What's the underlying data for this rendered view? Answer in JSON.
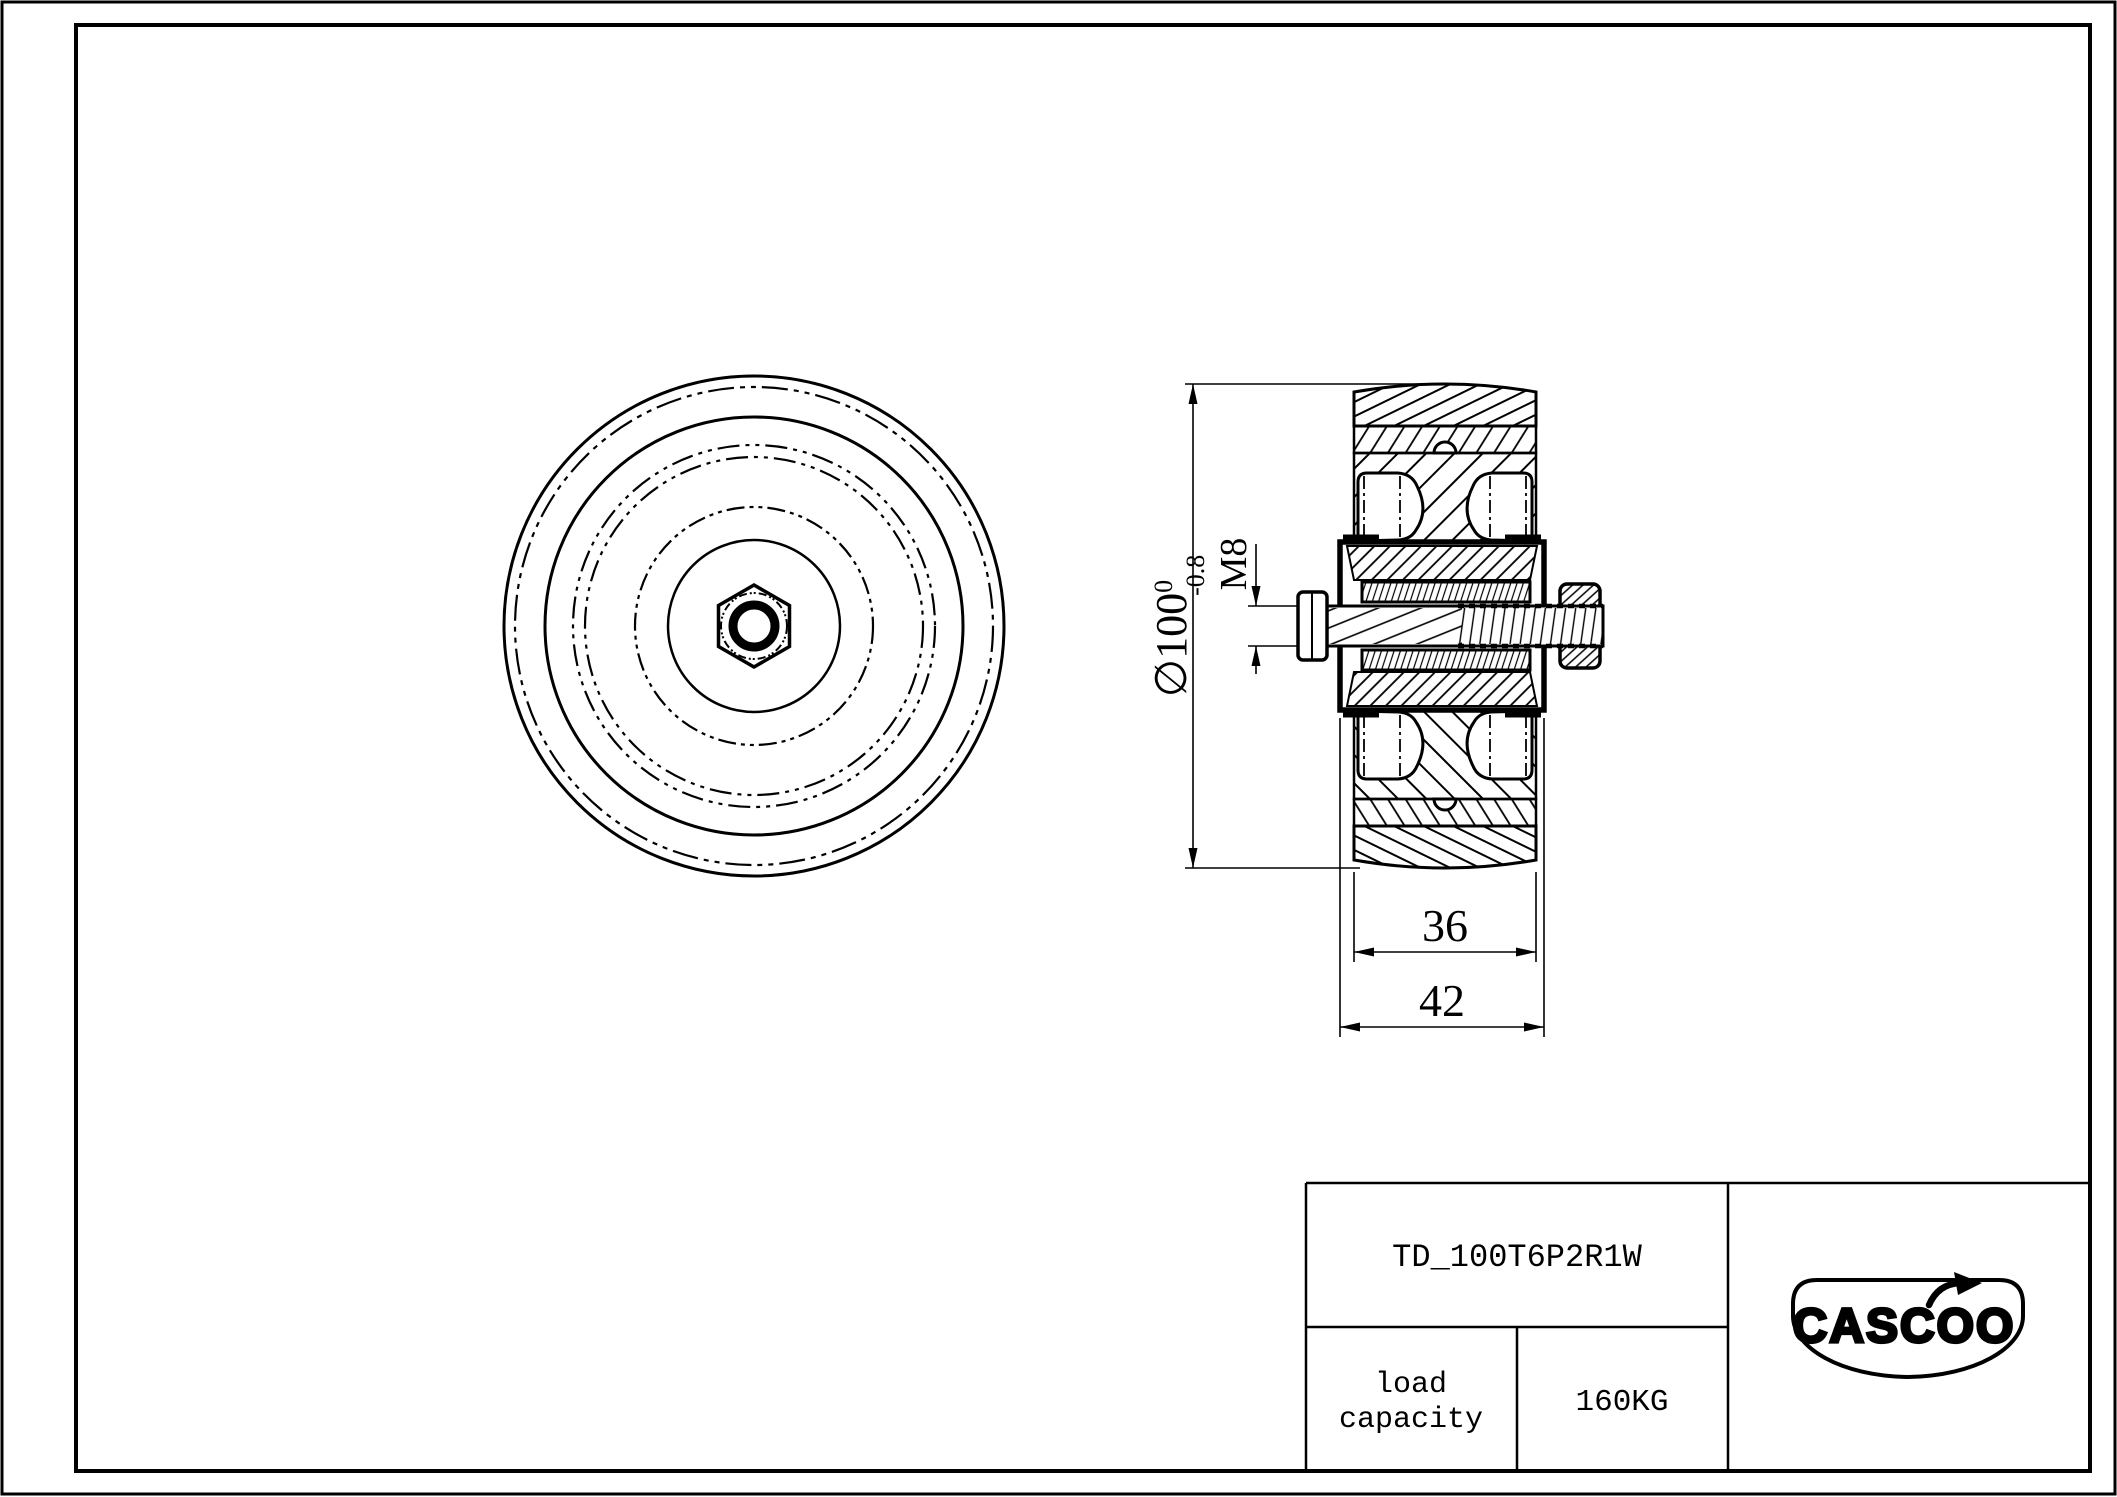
{
  "drawing": {
    "part_number": "TD_100T6P2R1W",
    "load_label_1": "load",
    "load_label_2": "capacity",
    "load_value": "160KG",
    "brand": "CASCOO",
    "dims": {
      "dia_symbol": "∅",
      "dia_value": "100",
      "dia_tol_upper": "0",
      "dia_tol_lower": "-0.8",
      "thread": "M8",
      "tread_width": "36",
      "hub_width": "42"
    },
    "colors": {
      "line": "#000000",
      "background": "#ffffff"
    }
  }
}
